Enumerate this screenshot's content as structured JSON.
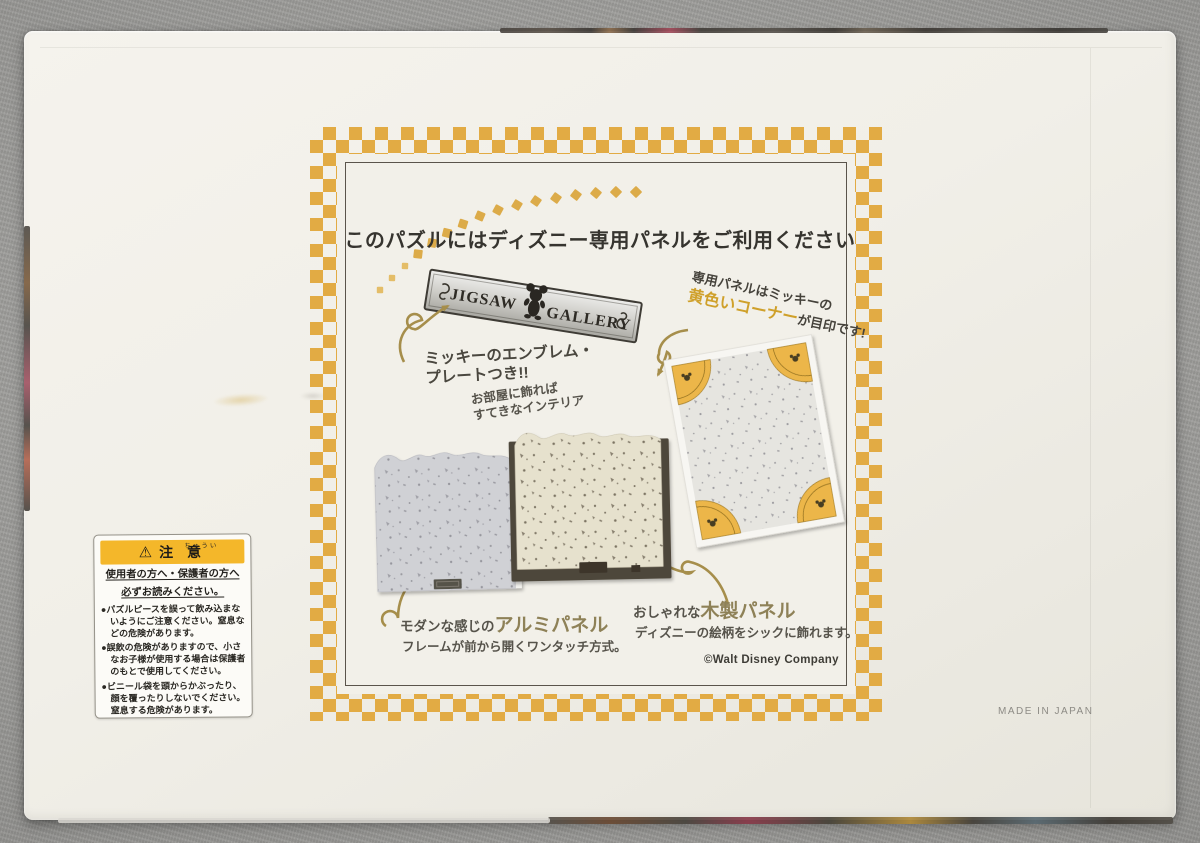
{
  "box_back": {
    "title": "このパズルにはディズニー専用パネルをご利用ください",
    "plate": {
      "left_word": "JIGSAW",
      "right_word": "GALLERY"
    },
    "emblem_note": {
      "line1": "ミッキーのエンブレム・",
      "line2": "プレートつき!!"
    },
    "interior_note": {
      "line1": "お部屋に飾れば",
      "line2": "すてきなインテリア"
    },
    "corner_note": {
      "line1": "専用パネルはミッキーの",
      "highlight": "黄色いコーナー",
      "tail": "が目印です!"
    },
    "aluminum_panel": {
      "prefix": "モダンな感じの",
      "name": "アルミパネル",
      "desc": "フレームが前から開くワンタッチ方式。"
    },
    "wooden_panel": {
      "prefix": "おしゃれな",
      "name": "木製パネル",
      "desc": "ディズニーの絵柄をシックに飾れます。"
    },
    "copyright": "©Walt Disney Company",
    "made_in": "MADE IN JAPAN"
  },
  "caution_label": {
    "warning_symbol": "⚠",
    "furigana": "ちゅうい",
    "title": "注 意",
    "lead1": "使用者の方へ・保護者の方へ",
    "lead2": "必ずお読みください。",
    "items": [
      "●パズルピースを誤って飲み込まないようにご注意ください。窒息などの危険があります。",
      "●誤飲の危険がありますので、小さなお子様が使用する場合は保護者のもとで使用してください。",
      "●ビニール袋を頭からかぶったり、顔を覆ったりしないでください。窒息する危険があります。"
    ]
  },
  "colors": {
    "checker_gold": "#e2ab44",
    "highlight_gold_text": "#cfa02a",
    "panel_name_bronze": "#8e8157",
    "caution_yellow": "#f4b72a",
    "box_cream": "#f2f0e9",
    "background_grey": "#a7a6a3"
  }
}
